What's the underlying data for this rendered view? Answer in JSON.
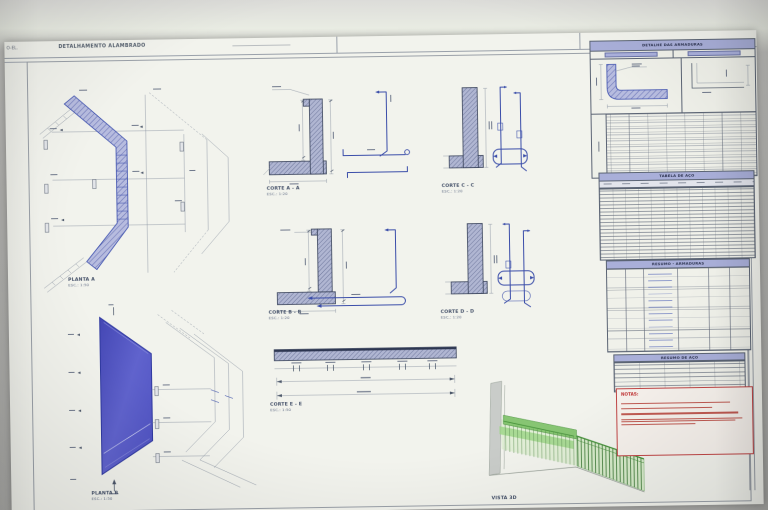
{
  "window": {
    "tab_prefix": "O-EL.",
    "title": "DETALHAMENTO ALAMBRADO"
  },
  "sections": {
    "plan_a": {
      "label": "PLANTA A",
      "scale": "ESC.: 1:50"
    },
    "plan_b": {
      "label": "PLANTA B",
      "scale": "ESC.: 1:50"
    },
    "corte_a": {
      "label": "CORTE A - A",
      "scale": "ESC.: 1:20"
    },
    "corte_b": {
      "label": "CORTE B - B",
      "scale": "ESC.: 1:20"
    },
    "corte_c": {
      "label": "CORTE C - C",
      "scale": "ESC.: 1:20"
    },
    "corte_d": {
      "label": "CORTE D - D",
      "scale": "ESC.: 1:20"
    },
    "corte_e": {
      "label": "CORTE E - E",
      "scale": "ESC.: 1:50"
    },
    "vista_3d": {
      "label": "VISTA 3D"
    }
  },
  "panels": {
    "armaduras": {
      "title": "DETALHE DAS ARMADURAS"
    },
    "tabela_aco": {
      "title": "TABELA DE AÇO"
    },
    "resumo_armaduras": {
      "title": "RESUMO - ARMADURAS"
    },
    "resumo_aco": {
      "title": "RESUMO DE AÇO"
    }
  },
  "notes": {
    "title": "NOTAS:"
  },
  "colors": {
    "hatch_blue": "#b7bcdf",
    "section_hatch": "#b0b6d2",
    "rebar_blue": "#3a4da9",
    "solid_plan_blue": "#5a5ec8",
    "fence_green": "#7cc166",
    "note_red": "#c04545",
    "table_header_blue": "#a9afd9"
  }
}
